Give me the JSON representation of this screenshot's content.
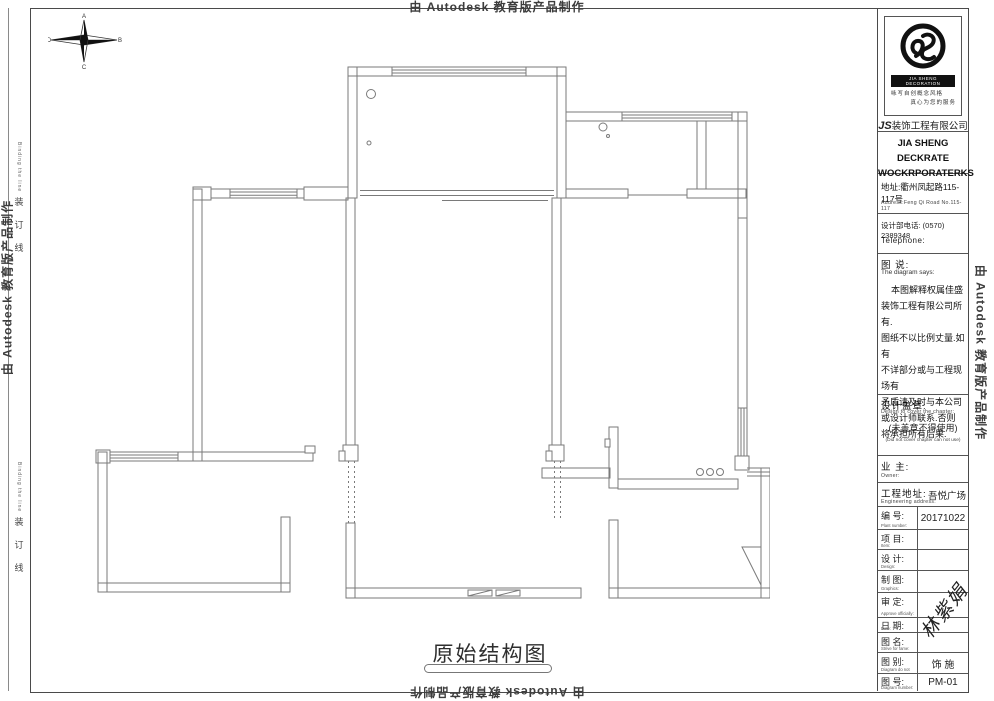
{
  "edge": {
    "autodesk_text": "由 Autodesk 教育版产品制作",
    "binding_cn": "装订线",
    "binding_en": "Binding the line"
  },
  "compass": {
    "top": "A",
    "right": "B",
    "bottom": "C",
    "left": "D"
  },
  "drawing": {
    "title": "原始结构图"
  },
  "title_block": {
    "logo": {
      "brand_en": "JIA SHENG DECORATION",
      "motto_line1": "咏写自创概念风格",
      "motto_line2": "真心为您的服务",
      "company_prefix": "JS",
      "company_cn": "装饰工程有限公司",
      "en_line1": "JIA SHENG DECKRATE",
      "en_line2": "WOCKRPORATERKS"
    },
    "address_cn": "地址:衢州凤起路115-117号",
    "address_en": "Address:Feng Qi Road No.115-117",
    "phone_cn": "设计部电话: (0570) 2389348",
    "phone_en": "Telephone:",
    "notes": {
      "label_cn": "图 说:",
      "label_en": "The diagram says:",
      "lines": [
        "本图解释权属佳盛",
        "装饰工程有限公司所有.",
        "图纸不以比例丈量.如有",
        "不详部分或与工程现场有",
        "矛盾请及时与本公司",
        "或设计师联系.否则",
        "将承担所有后果."
      ]
    },
    "stamp": {
      "label_cn": "设计盖章:",
      "label_en": "Design to cover the chapter:",
      "warn_cn": "(未盖章不得使用)",
      "warn_en": "(Did not cover chapter can not use)"
    },
    "owner": {
      "label_cn": "业 主:",
      "label_en": "Owner:",
      "value": ""
    },
    "site": {
      "label_cn": "工程地址:",
      "label_en": "Engineering address:",
      "value": "吾悦广场"
    },
    "rows": [
      {
        "cn": "编 号:",
        "en": "Plant number:",
        "value": "20171022"
      },
      {
        "cn": "项 目:",
        "en": "Item:",
        "value": ""
      },
      {
        "cn": "设 计:",
        "en": "Design:",
        "value": ""
      },
      {
        "cn": "制 图:",
        "en": "Graphics:",
        "value": ""
      },
      {
        "cn": "审 定:",
        "en": "Approve officially:",
        "value": ""
      },
      {
        "cn": "日 期:",
        "en": "Date:",
        "value": ""
      },
      {
        "cn": "图 名:",
        "en": "Strive for fame:",
        "value": ""
      },
      {
        "cn": "图 别:",
        "en": "Diagram do not",
        "value": "饰 施"
      },
      {
        "cn": "图 号:",
        "en": "Diagram number:",
        "value": "PM-01"
      }
    ],
    "signature": "林紫娟"
  }
}
